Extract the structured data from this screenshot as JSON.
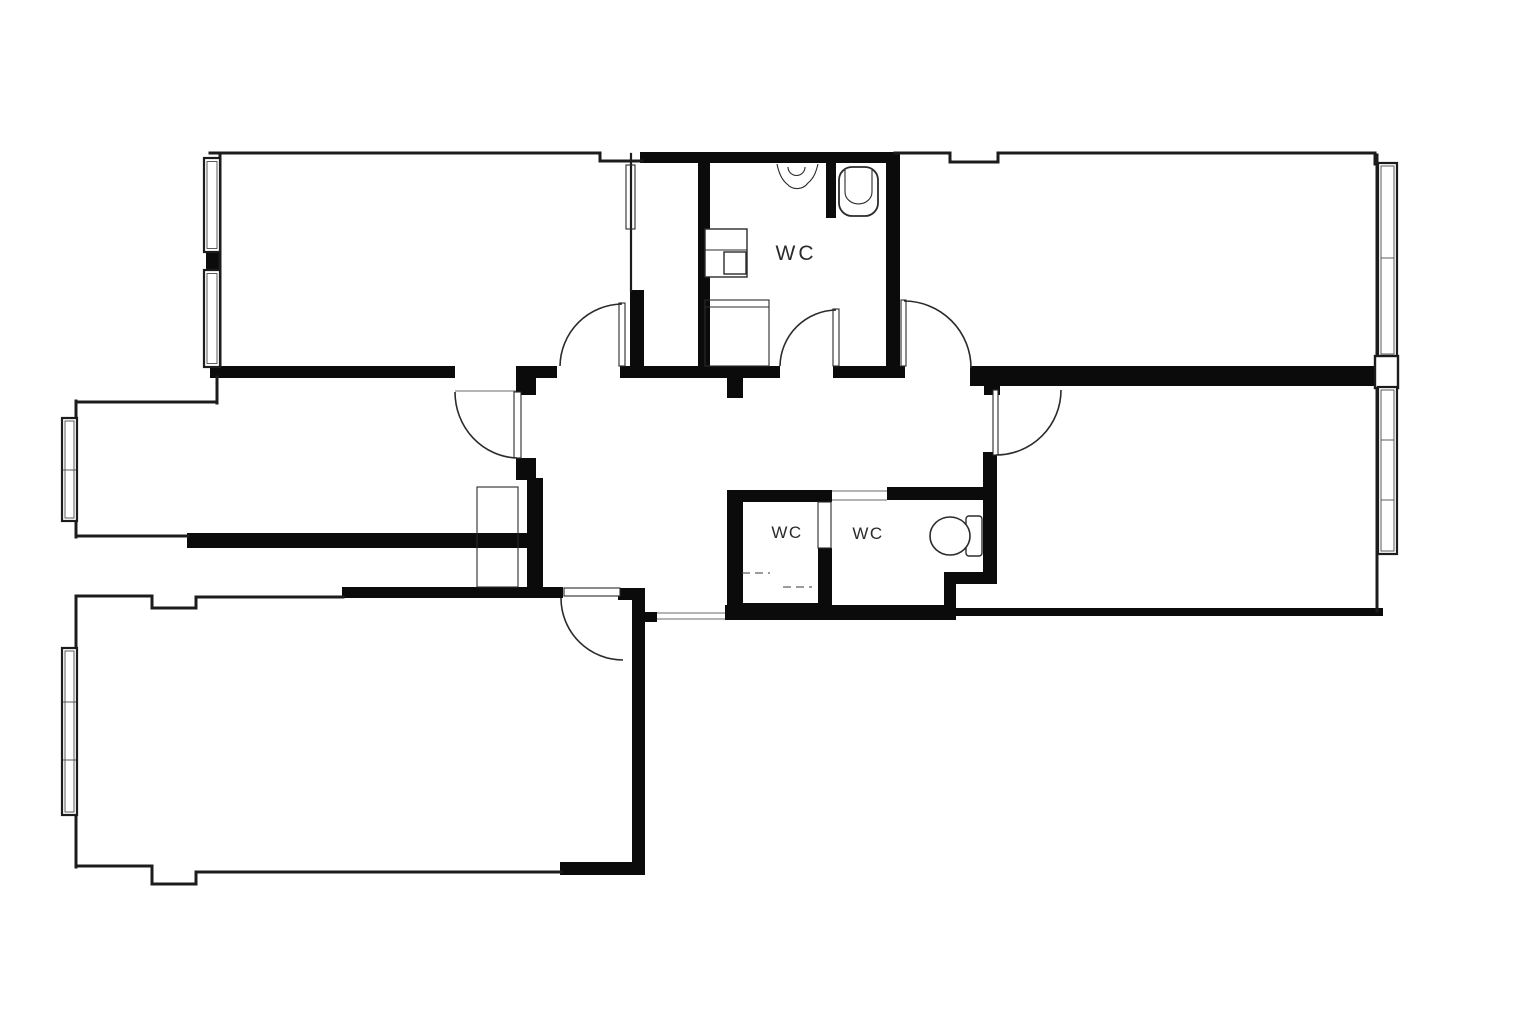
{
  "plan": {
    "type": "floor-plan",
    "colors": {
      "background": "#ffffff",
      "wall": "#0b0b0b",
      "line": "#1c1c1c",
      "fixture": "#2b2b2b"
    },
    "labels": {
      "wc_top": "WC",
      "wc_lower_left": "WC",
      "wc_lower_right": "WC"
    }
  }
}
